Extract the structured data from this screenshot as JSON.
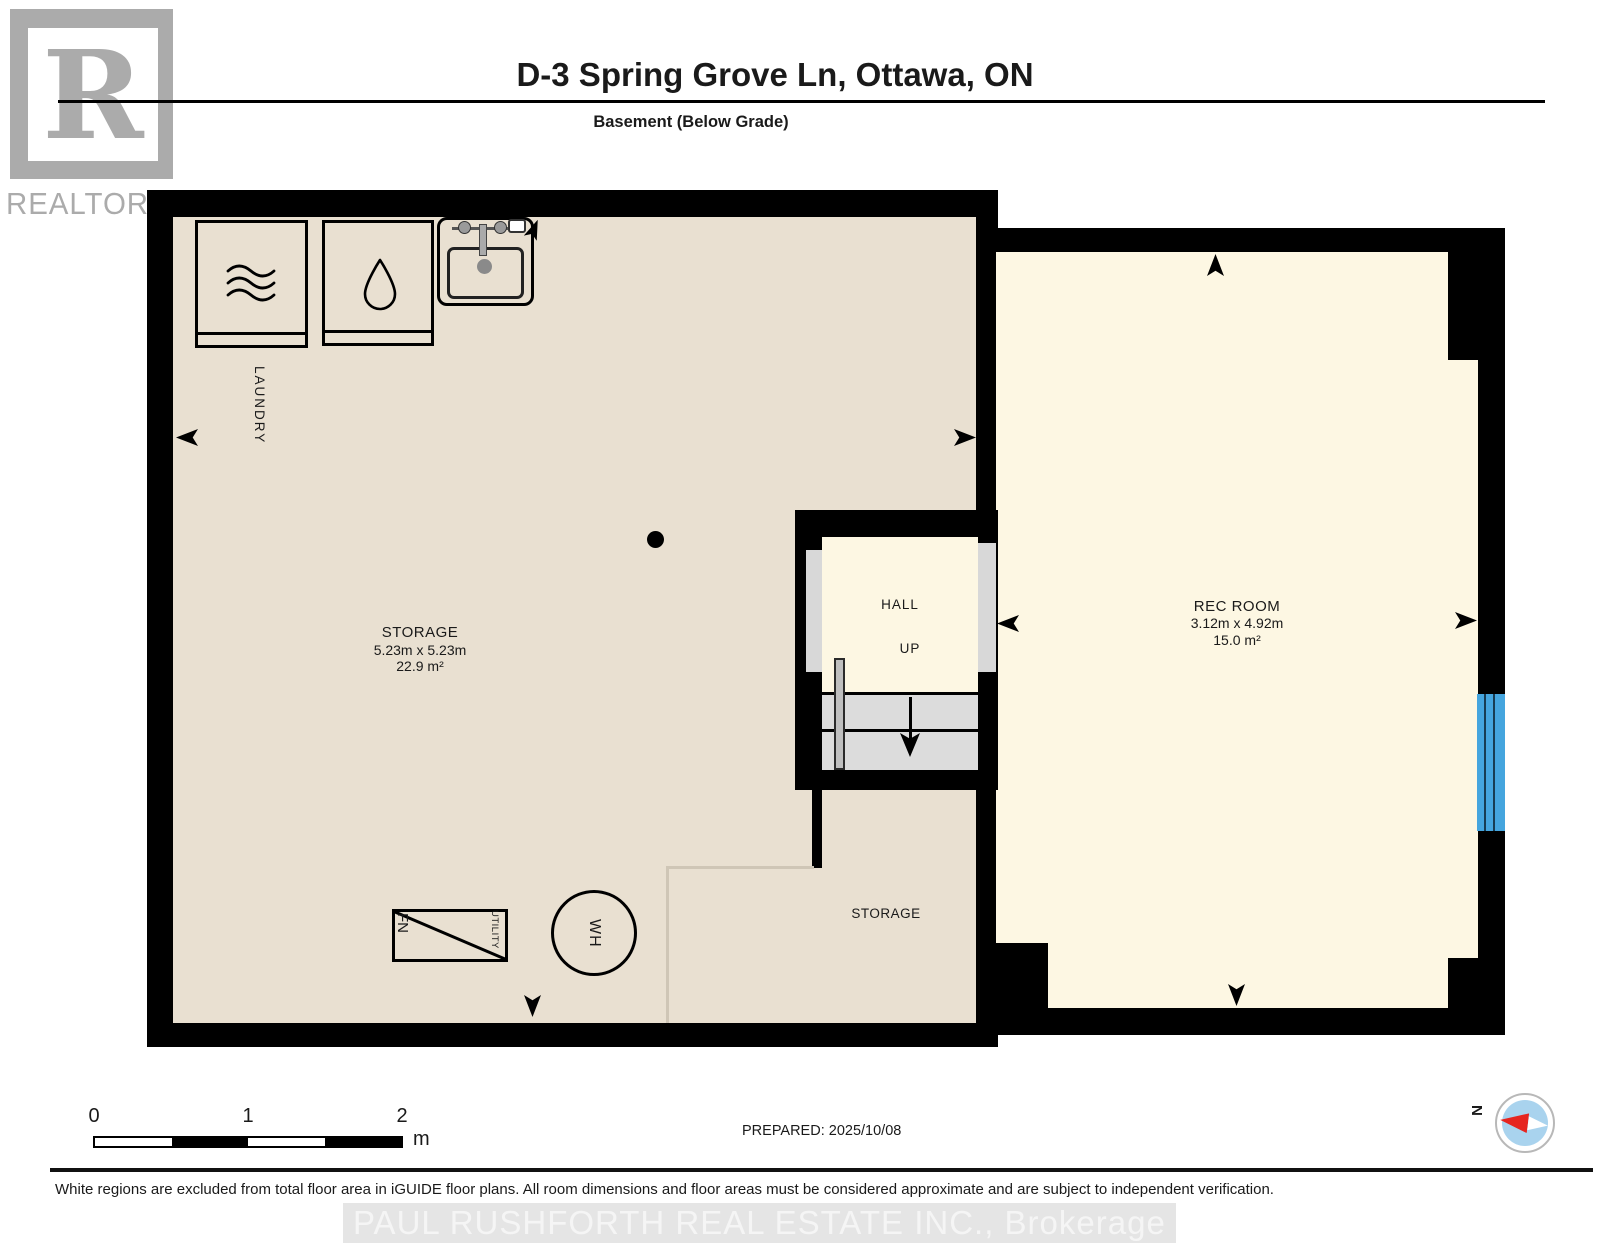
{
  "header": {
    "logo": {
      "letter": "R",
      "brand": "REALTOR",
      "registered": "®"
    },
    "title": "D-3 Spring Grove Ln, Ottawa, ON",
    "subtitle": "Basement (Below Grade)"
  },
  "plan": {
    "laundry_label": "LAUNDRY",
    "storage_main": {
      "name": "STORAGE",
      "dims": "5.23m x 5.23m",
      "area": "22.9 m²"
    },
    "hall": {
      "name": "HALL",
      "direction": "UP"
    },
    "rec_room": {
      "name": "REC ROOM",
      "dims": "3.12m x 4.92m",
      "area": "15.0 m²"
    },
    "storage_lower": {
      "name": "STORAGE"
    },
    "furnace_label": "FN",
    "utility_label": "UTILITY",
    "water_heater_label": "WH"
  },
  "scale_bar": {
    "tick0": "0",
    "tick1": "1",
    "tick2": "2",
    "unit": "m"
  },
  "prepared_label": "PREPARED: 2025/10/08",
  "compass": {
    "north_label": "N"
  },
  "footer": {
    "disclaimer": "White regions are excluded from total floor area in iGUIDE floor plans. All room dimensions and floor areas must be considered approximate and are subject to independent verification.",
    "watermark": "PAUL RUSHFORTH REAL ESTATE INC., Brokerage"
  },
  "colors": {
    "wall": "#000000",
    "floor-beige": "#e9e0d1",
    "floor-cream": "#fdf7e3",
    "door-gray": "#d8d8d8",
    "stair-gray": "#dcdcdc",
    "window-blue": "#45a5de",
    "compass-blue": "#a9d3ee",
    "compass-red": "#e62520",
    "logo-gray": "#ababab",
    "watermark-text": "#f5f5f5",
    "watermark-bg": "#e5e5e5"
  }
}
